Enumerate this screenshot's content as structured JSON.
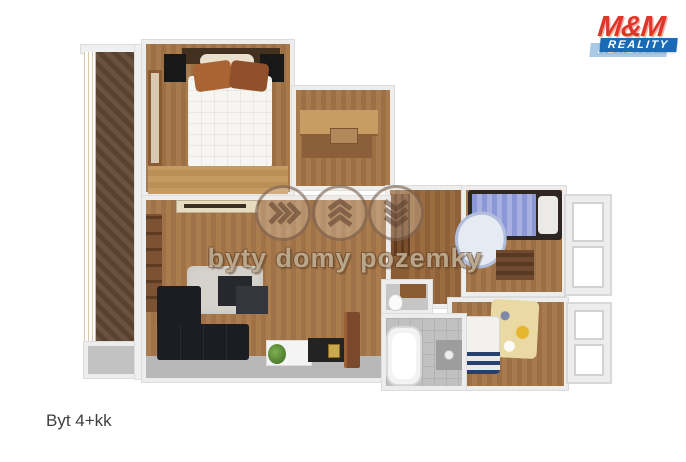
{
  "page": {
    "caption": "Byt 4+kk",
    "background": "#ffffff"
  },
  "logo": {
    "name": "M&M Reality",
    "mm": "M&M",
    "holding": "HOLDING",
    "reality": "REALITY",
    "reality_shadow": "REALITY",
    "colors": {
      "red": "#e23428",
      "blue": "#1a6bb5",
      "light_blue": "#9cc0e2"
    }
  },
  "watermark": {
    "text": "byty domy pozemky",
    "icons": [
      "chevrons-right-icon",
      "chevrons-up-icon",
      "chevrons-down-icon"
    ]
  },
  "floorplan": {
    "type": "3d-floor-plan",
    "colors": {
      "wood_floor": "#a87a4e",
      "light_wood": "#c59a63",
      "balcony_deck": "#62493a",
      "tile_gray": "#c1c1c1",
      "wall": "#ededed",
      "sofa_dark": "#1b1d22",
      "bed_white": "#f6f4f0",
      "kids_bed_blue": "#8b97d6",
      "kids_rug_yellow": "#ead9a2"
    }
  }
}
